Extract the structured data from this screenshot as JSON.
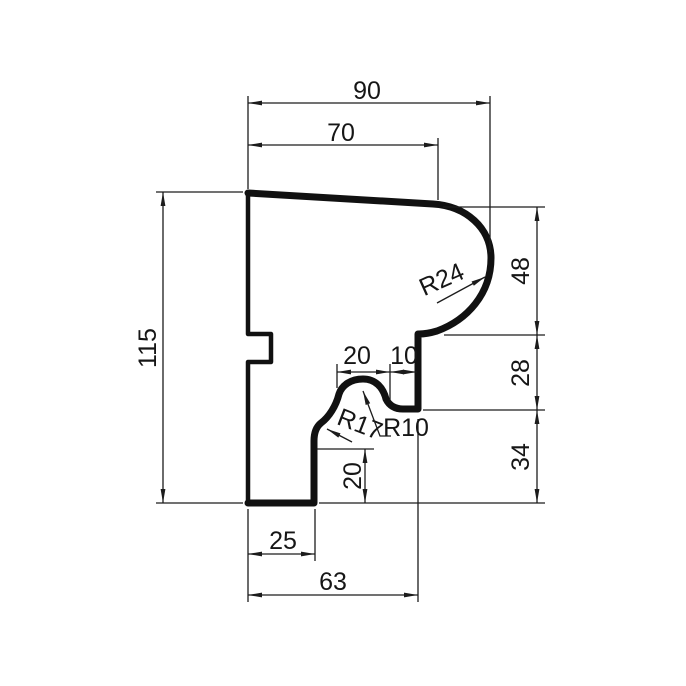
{
  "drawing": {
    "background": "#ffffff",
    "line_color": "#1c1c1c",
    "profile_color": "#111111",
    "dims": {
      "top_total": "90",
      "top_upper": "70",
      "left_height": "115",
      "right_upper": "48",
      "right_middle": "28",
      "right_lower": "34",
      "bump_width": "20",
      "bump_to_step": "10",
      "step_height": "20",
      "bottom_left": "25",
      "bottom_total": "63"
    },
    "radii": {
      "nose": "R24",
      "cove": "R17",
      "fillet": "R10"
    }
  }
}
